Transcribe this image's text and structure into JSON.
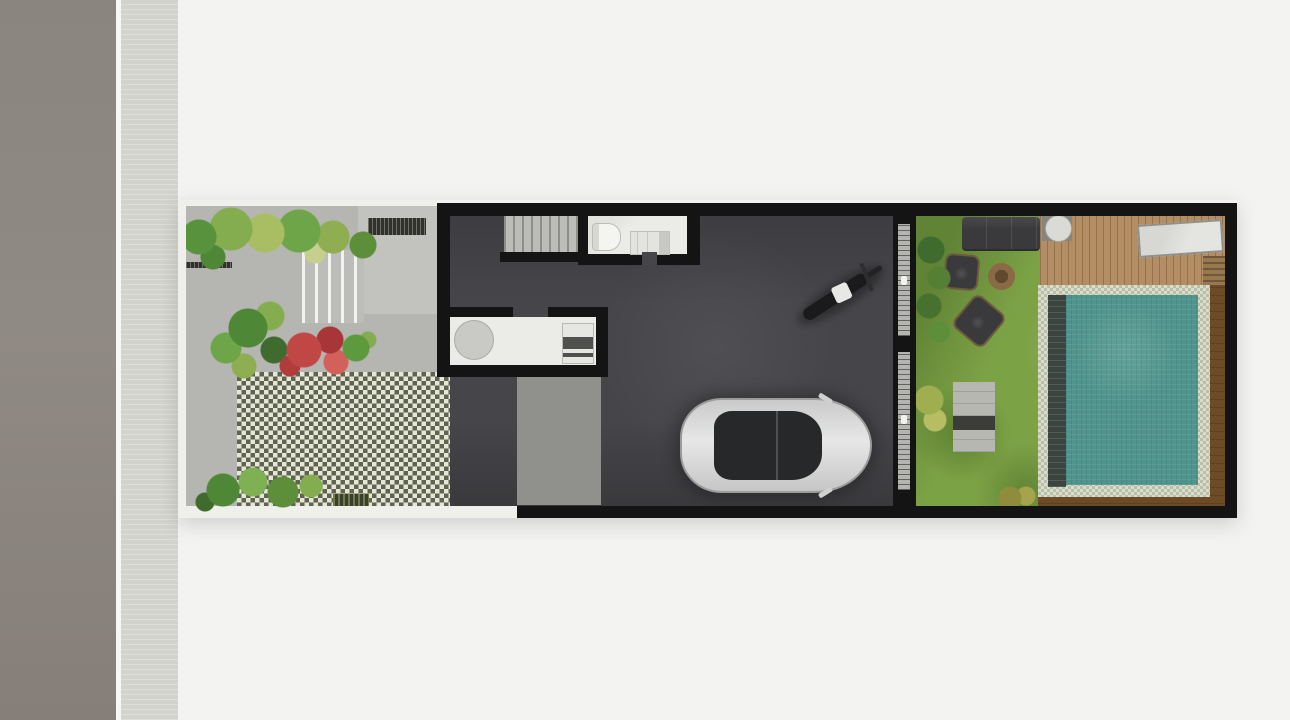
{
  "scene": {
    "type": "architectural-site-plan-render",
    "description": "Top-down 3D rendered floor plan of a long narrow townhouse lot between a street (left) and rear pool garden (right)",
    "no_visible_text": true,
    "areas": [
      {
        "id": "road",
        "label": "street asphalt strip"
      },
      {
        "id": "sidewalk",
        "label": "sidewalk strip with curb line"
      },
      {
        "id": "front-garden",
        "label": "front garden with paved path, steps, planters and grass-block pavers"
      },
      {
        "id": "house",
        "label": "dark-floored house volume with stairs, bathroom, kitchen and carport"
      },
      {
        "id": "backyard",
        "label": "rear lawn with outdoor furniture"
      },
      {
        "id": "pool-deck",
        "label": "wooden deck with table and lounger"
      },
      {
        "id": "pool",
        "label": "tiled swimming pool with wooden surround"
      }
    ],
    "objects": [
      {
        "id": "foliage-top",
        "label": "tree canopy row along garden street edge"
      },
      {
        "id": "red-bush",
        "label": "red flowering shrub in planter"
      },
      {
        "id": "palm-plants",
        "label": "palm plants in planter and at garden bottom"
      },
      {
        "id": "garden-steps",
        "label": "entry steps"
      },
      {
        "id": "grass-pavers",
        "label": "checkerboard grass-block paving"
      },
      {
        "id": "stairs",
        "label": "interior staircase"
      },
      {
        "id": "bathroom",
        "label": "bathroom with toilet and vanity"
      },
      {
        "id": "kitchen",
        "label": "kitchen counter with round table and cooktop"
      },
      {
        "id": "car",
        "label": "silver sedan parked in carport, facing right"
      },
      {
        "id": "motorcycle",
        "label": "motorcycle parked diagonally"
      },
      {
        "id": "sliding-doors",
        "label": "two sliding glass doors between carport and backyard"
      },
      {
        "id": "sofa",
        "label": "dark outdoor sofa"
      },
      {
        "id": "armchairs",
        "label": "two dark outdoor armchairs"
      },
      {
        "id": "fire-pit",
        "label": "round fire pit table"
      },
      {
        "id": "deck-table",
        "label": "round table on wooden deck"
      },
      {
        "id": "lounger",
        "label": "light lounger slab on deck"
      },
      {
        "id": "bench-steps",
        "label": "concrete bench steps on lawn"
      },
      {
        "id": "pool",
        "label": "rectangular teal pool with light tile coping"
      }
    ]
  },
  "palette": {
    "bg": "#f3f3f1",
    "curb": "#f7f7f5",
    "sidewalk": "#d3d3ce",
    "garden_pave": "#b5b6b2",
    "garden_pave_light": "#c2c3bf",
    "white_edge": "#efefeb",
    "wall": "#141414",
    "floor_dark": "#46464a",
    "apron": "#90908c",
    "stairs_bg": "#bcbcb9",
    "stairs_line": "#8e8e8b",
    "room_white": "#ebebe8",
    "fixture": "#c9c9c5",
    "track": "#b4b4b1",
    "checker_light": "#e5e5d9",
    "checker_dark": "#5e644d",
    "grate": "#31312b",
    "lawn": "#7ca246",
    "deck": "#b38d63",
    "sofa": "#3a3a3c",
    "firepit": "#8a6a44",
    "bench": "#b7b7b2",
    "bench_dark": "#3c3c38",
    "pool_wood": "#6d4b27",
    "pool_coping": "#d9ddc9",
    "pool_edge_dark": "#3c443f",
    "pool_water": "#4f958d",
    "car_glass": "#26282a",
    "moto": "#1a1a1c",
    "moto_white": "#e8e8e6"
  }
}
